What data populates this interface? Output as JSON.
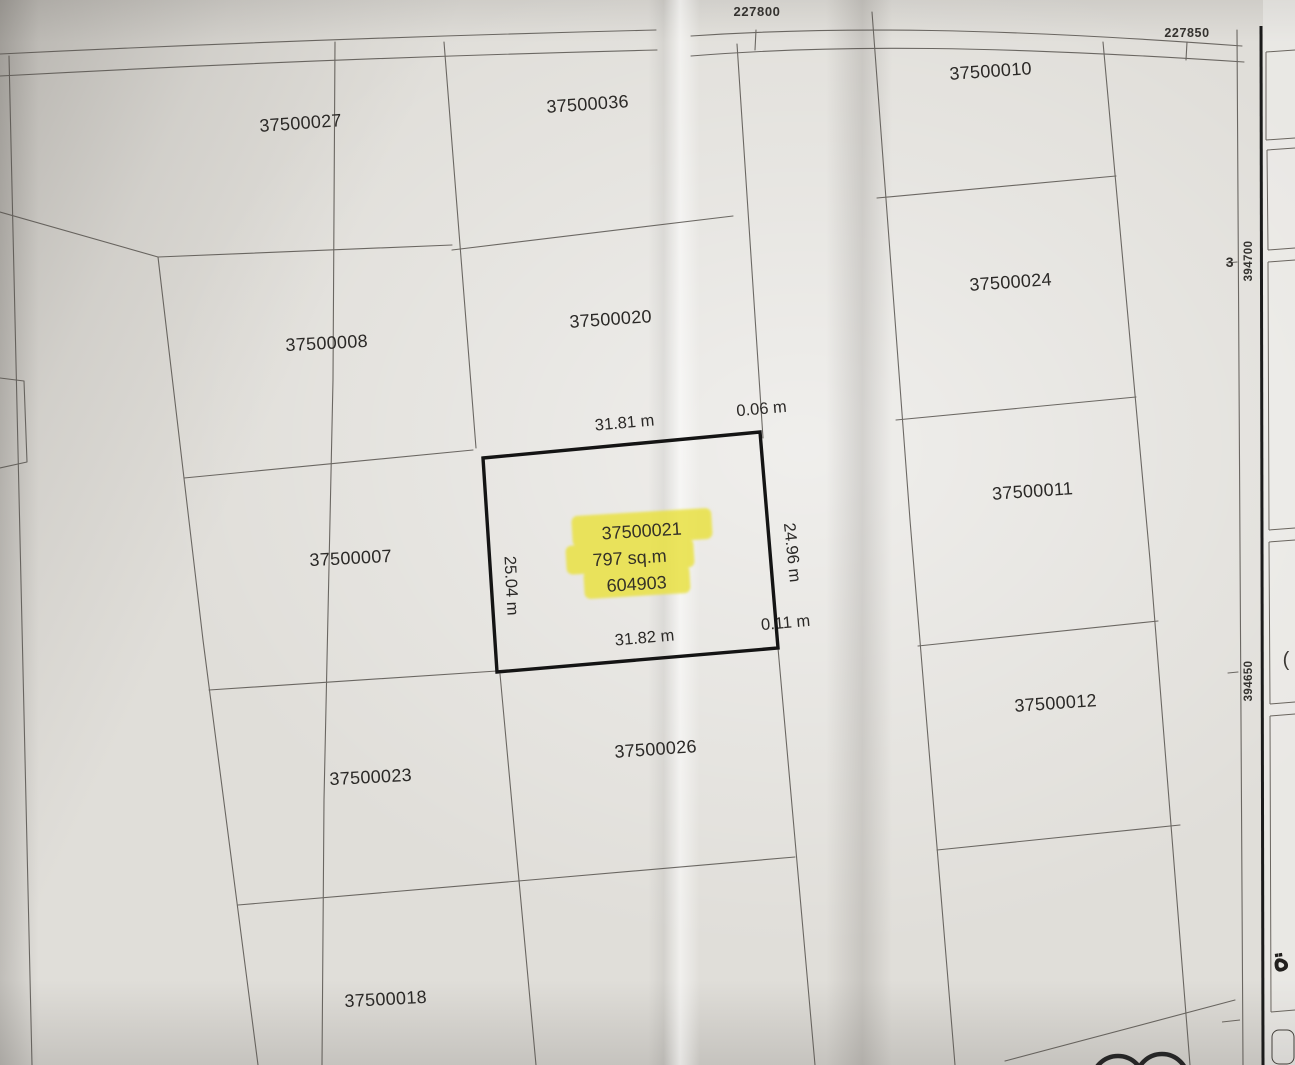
{
  "parcels": [
    "37500027",
    "37500036",
    "37500010",
    "37500008",
    "37500020",
    "37500024",
    "37500007",
    "37500011",
    "37500023",
    "37500026",
    "37500012",
    "37500018"
  ],
  "highlighted_parcel": {
    "parcel_id": "37500021",
    "area": "797 sq.m",
    "number": "604903"
  },
  "dimensions": {
    "top": "31.81 m",
    "top_offset": "0.06 m",
    "left": "25.04 m",
    "right": "24.96 m",
    "bottom": "31.82 m",
    "bottom_offset": "0.11 m"
  },
  "grid": {
    "easting": [
      "227800",
      "227850"
    ],
    "northing": [
      "394700",
      "394650"
    ],
    "partial_label": "3"
  },
  "margin": {
    "open_paren": "(",
    "arabic_letter": "ة"
  },
  "colors": {
    "highlighter": "#e9e13c",
    "paper": "#e0ded9",
    "ink": "#2b2927",
    "boundary": "#56524d",
    "frame": "#1b1b1b"
  }
}
